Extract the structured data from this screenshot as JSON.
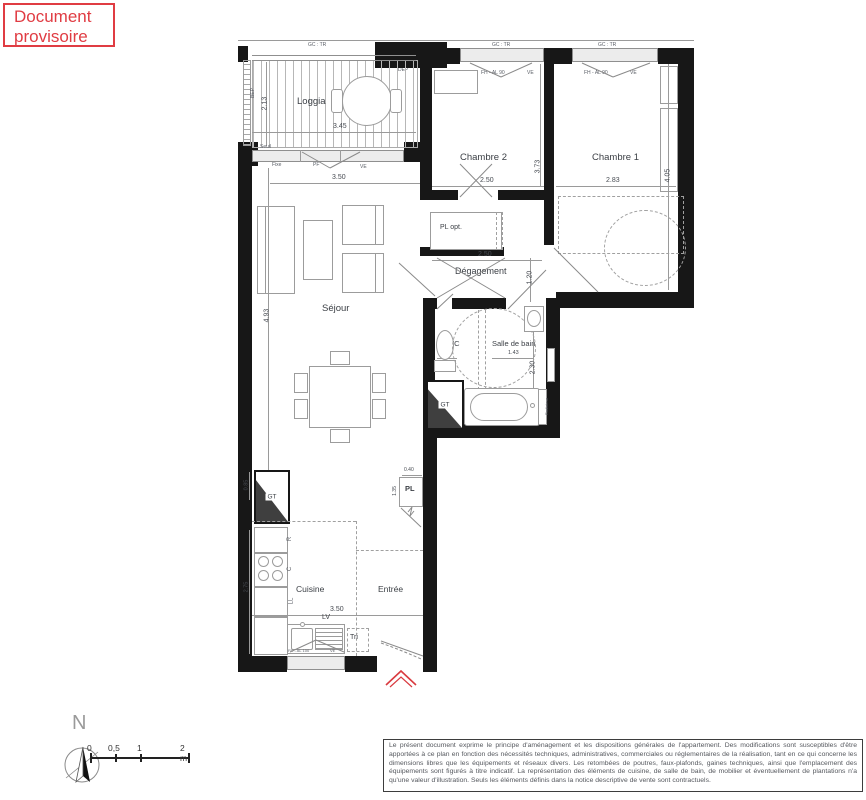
{
  "stamp": {
    "line1": "Document",
    "line2": "provisoire"
  },
  "colors": {
    "stamp_red": "#e03c43",
    "wall_black": "#171717"
  },
  "top_labels": {
    "gc_tr_1": "GC : TR",
    "gc_tr_2": "GC : TR",
    "gc_tr_3": "GC : TR",
    "dep": "DEP"
  },
  "loggia": {
    "name": "Loggia",
    "dim_width": "3.45",
    "dim_depth": "2.13",
    "bep": "BEP",
    "seuil": "Seuil",
    "fixe": "Fixe",
    "pf": "PF",
    "ve": "VE",
    "dim_bay": "3.50"
  },
  "chambre2": {
    "name": "Chambre 2",
    "dim_width": "2.50",
    "dim_depth": "3.73",
    "window": "FH - AL 90",
    "window_ve": "VE"
  },
  "chambre1": {
    "name": "Chambre 1",
    "dim_width": "2.83",
    "dim_depth": "4.05",
    "window": "FH - AL 90",
    "window_ve": "VE"
  },
  "degagement": {
    "name": "Dégagement",
    "dim_width": "2.50",
    "dim_depth": "1.20",
    "pl_opt": "PL opt."
  },
  "sejour": {
    "name": "Séjour",
    "dim_depth": "4.93"
  },
  "wc": {
    "name": "WC",
    "dim_width": "0.76",
    "s": "S"
  },
  "salle_de_bain": {
    "name": "Salle de bain",
    "dim_width": "1.43",
    "dim_depth": "2.30",
    "gt": "GT",
    "radiateur": "Radiateur"
  },
  "cuisine": {
    "name": "Cuisine",
    "dim_width": "3.50",
    "gt": "GT",
    "dim_gt": "0.85",
    "dim_left": "2.75",
    "r": "R",
    "c": "C",
    "ll": "LL",
    "lv": "LV",
    "tri": "Tri",
    "window": "FH - AL 100",
    "window_ve": "VE"
  },
  "entree": {
    "name": "Entrée",
    "pl": "PL",
    "dim_pl_w": "0.40",
    "dim_pl_h": "1.35"
  },
  "compass": {
    "north": "N"
  },
  "scale_bar": {
    "t0": "0",
    "t05": "0,5",
    "t1": "1",
    "t2": "2 m"
  },
  "disclaimer": {
    "text": "Le présent document exprime le principe d'aménagement et les dispositions générales de l'appartement. Des modifications sont susceptibles d'être apportées à ce plan en fonction des nécessités techniques, administratives, commerciales ou réglementaires de la réalisation, tant en ce qui concerne les dimensions libres que les équipements et réseaux divers. Les retombées de poutres, faux-plafonds, gaines techniques, ainsi que l'emplacement des équipements sont figurés à titre indicatif. La représentation des éléments de cuisine, de salle de bain, de mobilier et éventuellement de plantations n'a qu'une valeur d'illustration. Seuls les éléments définis dans la notice descriptive de vente sont contractuels."
  }
}
